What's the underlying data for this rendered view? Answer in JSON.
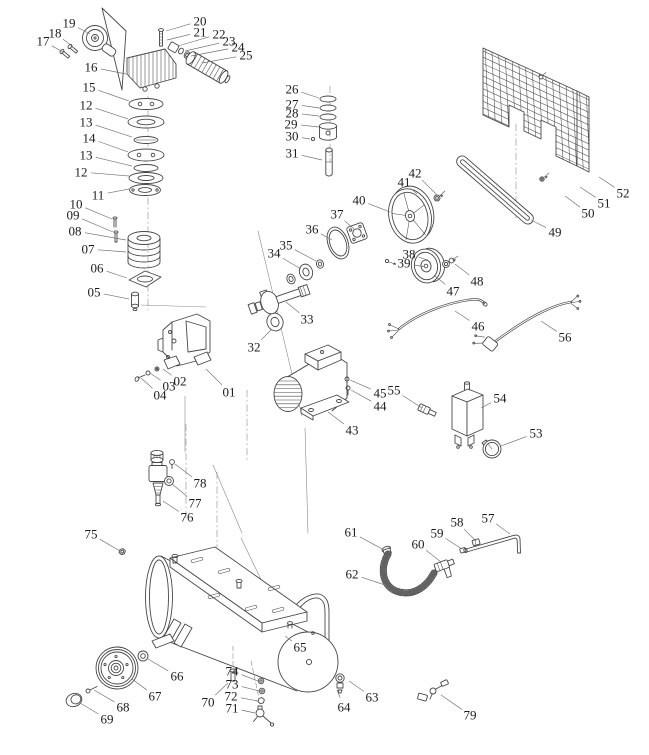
{
  "diagram": {
    "subject": "Air compressor exploded parts diagram",
    "background": "#ffffff",
    "line_color": "#474747",
    "label_color": "#1c1c1c",
    "leader_color": "#6f6f6f",
    "label_font_size": 13,
    "part_labels": [
      {
        "text": "19",
        "x": 69,
        "y": 23,
        "tx": 90,
        "ty": 34
      },
      {
        "text": "18",
        "x": 55,
        "y": 33,
        "tx": 72,
        "ty": 46
      },
      {
        "text": "17",
        "x": 43,
        "y": 41,
        "tx": 63,
        "ty": 52
      },
      {
        "text": "16",
        "x": 91,
        "y": 67,
        "tx": 126,
        "ty": 74
      },
      {
        "text": "15",
        "x": 89,
        "y": 87,
        "tx": 129,
        "ty": 101
      },
      {
        "text": "12",
        "x": 86,
        "y": 105,
        "tx": 128,
        "ty": 119
      },
      {
        "text": "13",
        "x": 86,
        "y": 122,
        "tx": 132,
        "ty": 137
      },
      {
        "text": "14",
        "x": 89,
        "y": 138,
        "tx": 128,
        "ty": 152
      },
      {
        "text": "13",
        "x": 86,
        "y": 155,
        "tx": 132,
        "ty": 166
      },
      {
        "text": "12",
        "x": 81,
        "y": 172,
        "tx": 129,
        "ty": 176
      },
      {
        "text": "11",
        "x": 98,
        "y": 195,
        "tx": 129,
        "ty": 189
      },
      {
        "text": "10",
        "x": 76,
        "y": 204,
        "tx": 112,
        "ty": 219
      },
      {
        "text": "09",
        "x": 73,
        "y": 215,
        "tx": 113,
        "ty": 232
      },
      {
        "text": "08",
        "x": 75,
        "y": 231,
        "tx": 126,
        "ty": 240
      },
      {
        "text": "07",
        "x": 88,
        "y": 249,
        "tx": 126,
        "ty": 252
      },
      {
        "text": "06",
        "x": 97,
        "y": 268,
        "tx": 127,
        "ty": 278
      },
      {
        "text": "05",
        "x": 94,
        "y": 292,
        "tx": 129,
        "ty": 299
      },
      {
        "text": "20",
        "x": 200,
        "y": 21,
        "tx": 166,
        "ty": 31
      },
      {
        "text": "21",
        "x": 200,
        "y": 32,
        "tx": 167,
        "ty": 40
      },
      {
        "text": "22",
        "x": 219,
        "y": 34,
        "tx": 178,
        "ty": 46
      },
      {
        "text": "23",
        "x": 229,
        "y": 41,
        "tx": 185,
        "ty": 51
      },
      {
        "text": "24",
        "x": 238,
        "y": 47,
        "tx": 191,
        "ty": 56
      },
      {
        "text": "25",
        "x": 246,
        "y": 55,
        "tx": 202,
        "ty": 63
      },
      {
        "text": "26",
        "x": 292,
        "y": 89,
        "tx": 319,
        "ty": 98
      },
      {
        "text": "27",
        "x": 292,
        "y": 104,
        "tx": 319,
        "ty": 108
      },
      {
        "text": "28",
        "x": 292,
        "y": 113,
        "tx": 319,
        "ty": 116
      },
      {
        "text": "29",
        "x": 291,
        "y": 124,
        "tx": 319,
        "ty": 127
      },
      {
        "text": "30",
        "x": 292,
        "y": 136,
        "tx": 310,
        "ty": 139
      },
      {
        "text": "31",
        "x": 292,
        "y": 153,
        "tx": 322,
        "ty": 160
      },
      {
        "text": "42",
        "x": 415,
        "y": 173,
        "tx": 437,
        "ty": 195
      },
      {
        "text": "41",
        "x": 404,
        "y": 182,
        "tx": 417,
        "ty": 194
      },
      {
        "text": "40",
        "x": 359,
        "y": 200,
        "tx": 390,
        "ty": 212
      },
      {
        "text": "37",
        "x": 337,
        "y": 214,
        "tx": 354,
        "ty": 229
      },
      {
        "text": "36",
        "x": 312,
        "y": 229,
        "tx": 332,
        "ty": 240
      },
      {
        "text": "35",
        "x": 286,
        "y": 245,
        "tx": 316,
        "ty": 261
      },
      {
        "text": "34",
        "x": 274,
        "y": 253,
        "tx": 301,
        "ty": 269
      },
      {
        "text": "38",
        "x": 409,
        "y": 254,
        "tx": 428,
        "ty": 260
      },
      {
        "text": "39",
        "x": 404,
        "y": 263,
        "tx": 425,
        "ty": 267
      },
      {
        "text": "33",
        "x": 307,
        "y": 319,
        "tx": 286,
        "ty": 302
      },
      {
        "text": "32",
        "x": 254,
        "y": 347,
        "tx": 272,
        "ty": 329
      },
      {
        "text": "49",
        "x": 555,
        "y": 232,
        "tx": 531,
        "ty": 220
      },
      {
        "text": "50",
        "x": 588,
        "y": 213,
        "tx": 565,
        "ty": 196
      },
      {
        "text": "51",
        "x": 604,
        "y": 203,
        "tx": 580,
        "ty": 187
      },
      {
        "text": "52",
        "x": 623,
        "y": 193,
        "tx": 599,
        "ty": 177
      },
      {
        "text": "48",
        "x": 477,
        "y": 281,
        "tx": 455,
        "ty": 264
      },
      {
        "text": "47",
        "x": 453,
        "y": 291,
        "tx": 434,
        "ty": 275
      },
      {
        "text": "46",
        "x": 478,
        "y": 326,
        "tx": 455,
        "ty": 311
      },
      {
        "text": "56",
        "x": 565,
        "y": 337,
        "tx": 541,
        "ty": 321
      },
      {
        "text": "01",
        "x": 229,
        "y": 392,
        "tx": 206,
        "ty": 369
      },
      {
        "text": "02",
        "x": 180,
        "y": 381,
        "tx": 163,
        "ty": 369
      },
      {
        "text": "03",
        "x": 169,
        "y": 386,
        "tx": 150,
        "ty": 373
      },
      {
        "text": "04",
        "x": 160,
        "y": 395,
        "tx": 141,
        "ty": 378
      },
      {
        "text": "43",
        "x": 352,
        "y": 430,
        "tx": 328,
        "ty": 412
      },
      {
        "text": "44",
        "x": 380,
        "y": 406,
        "tx": 351,
        "ty": 390
      },
      {
        "text": "45",
        "x": 380,
        "y": 393,
        "tx": 350,
        "ty": 380
      },
      {
        "text": "55",
        "x": 394,
        "y": 390,
        "tx": 422,
        "ty": 408
      },
      {
        "text": "54",
        "x": 500,
        "y": 398,
        "tx": 481,
        "ty": 408
      },
      {
        "text": "53",
        "x": 536,
        "y": 433,
        "tx": 501,
        "ty": 446
      },
      {
        "text": "78",
        "x": 200,
        "y": 483,
        "tx": 175,
        "ty": 464
      },
      {
        "text": "77",
        "x": 195,
        "y": 503,
        "tx": 172,
        "ty": 484
      },
      {
        "text": "76",
        "x": 187,
        "y": 517,
        "tx": 163,
        "ty": 501
      },
      {
        "text": "75",
        "x": 91,
        "y": 534,
        "tx": 120,
        "ty": 551
      },
      {
        "text": "61",
        "x": 351,
        "y": 532,
        "tx": 384,
        "ty": 550
      },
      {
        "text": "62",
        "x": 352,
        "y": 574,
        "tx": 388,
        "ty": 586
      },
      {
        "text": "60",
        "x": 418,
        "y": 544,
        "tx": 441,
        "ty": 562
      },
      {
        "text": "59",
        "x": 437,
        "y": 533,
        "tx": 462,
        "ty": 549
      },
      {
        "text": "58",
        "x": 457,
        "y": 522,
        "tx": 476,
        "ty": 541
      },
      {
        "text": "57",
        "x": 488,
        "y": 518,
        "tx": 510,
        "ty": 534
      },
      {
        "text": "65",
        "x": 300,
        "y": 647,
        "tx": 285,
        "ty": 636
      },
      {
        "text": "66",
        "x": 177,
        "y": 676,
        "tx": 148,
        "ty": 659
      },
      {
        "text": "67",
        "x": 155,
        "y": 696,
        "tx": 132,
        "ty": 679
      },
      {
        "text": "68",
        "x": 123,
        "y": 707,
        "tx": 94,
        "ty": 690
      },
      {
        "text": "69",
        "x": 107,
        "y": 719,
        "tx": 80,
        "ty": 703
      },
      {
        "text": "70",
        "x": 208,
        "y": 702,
        "tx": 228,
        "ty": 683
      },
      {
        "text": "74",
        "x": 232,
        "y": 671,
        "tx": 258,
        "ty": 681
      },
      {
        "text": "73",
        "x": 232,
        "y": 684,
        "tx": 259,
        "ty": 691
      },
      {
        "text": "72",
        "x": 231,
        "y": 696,
        "tx": 258,
        "ty": 701
      },
      {
        "text": "71",
        "x": 232,
        "y": 708,
        "tx": 255,
        "ty": 713
      },
      {
        "text": "64",
        "x": 344,
        "y": 707,
        "tx": 337,
        "ty": 690
      },
      {
        "text": "63",
        "x": 372,
        "y": 697,
        "tx": 349,
        "ty": 681
      },
      {
        "text": "79",
        "x": 470,
        "y": 715,
        "tx": 441,
        "ty": 695
      }
    ]
  }
}
